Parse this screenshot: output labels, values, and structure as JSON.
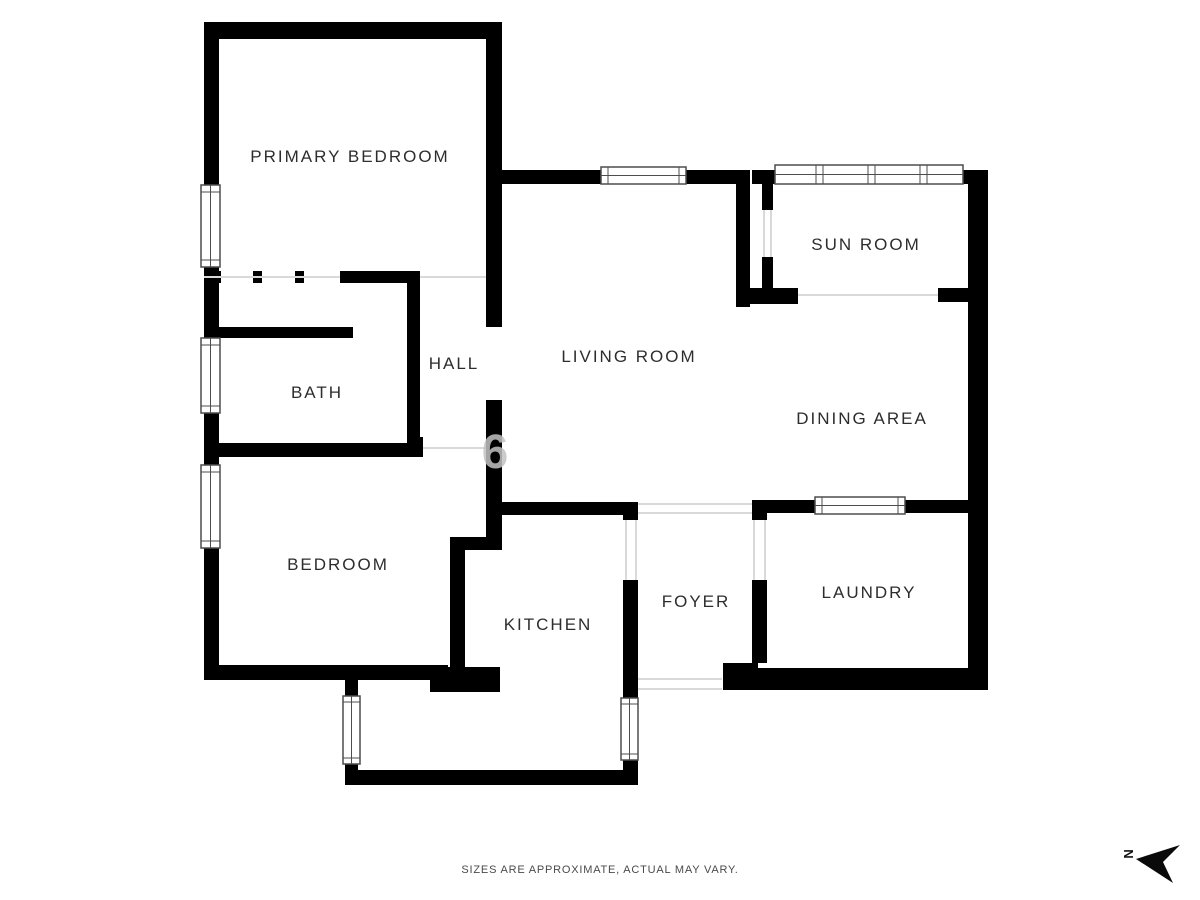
{
  "floor_plan": {
    "rooms": [
      {
        "name": "primary-bedroom",
        "label": "PRIMARY BEDROOM"
      },
      {
        "name": "sun-room",
        "label": "SUN ROOM"
      },
      {
        "name": "living-room",
        "label": "LIVING ROOM"
      },
      {
        "name": "dining-area",
        "label": "DINING AREA"
      },
      {
        "name": "hall",
        "label": "HALL"
      },
      {
        "name": "bath",
        "label": "BATH"
      },
      {
        "name": "bedroom",
        "label": "BEDROOM"
      },
      {
        "name": "kitchen",
        "label": "KITCHEN"
      },
      {
        "name": "foyer",
        "label": "FOYER"
      },
      {
        "name": "laundry",
        "label": "LAUNDRY"
      }
    ],
    "watermark": "6",
    "disclaimer": "SIZES ARE APPROXIMATE, ACTUAL MAY VARY.",
    "compass": {
      "label": "N"
    },
    "colors": {
      "wall": "#000000",
      "background": "#ffffff",
      "label_text": "#2d2d2d",
      "disclaimer_text": "#4a4a4a",
      "watermark": "#c2c2c2",
      "window_stroke": "#4d4d4d",
      "floor_line": "#d9d9d9"
    }
  }
}
